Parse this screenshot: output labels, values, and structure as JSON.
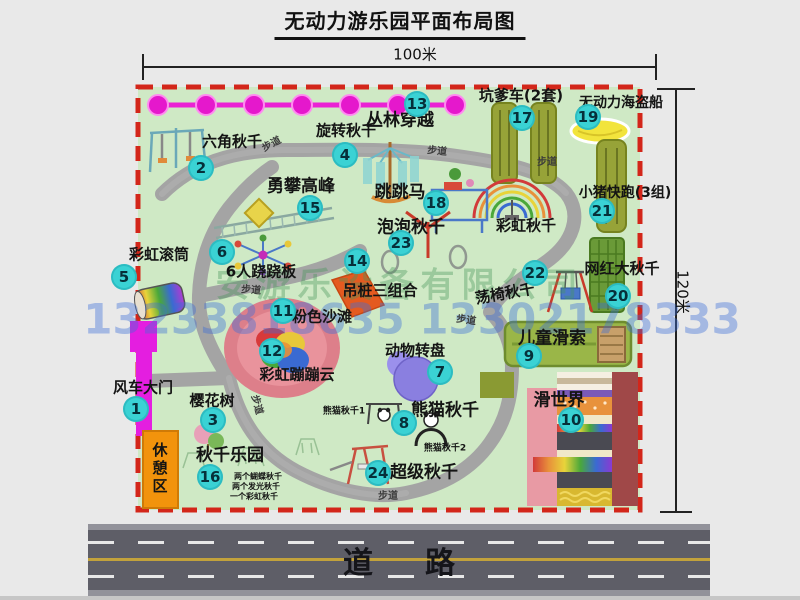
{
  "title": "无动力游乐园平面布局图",
  "dimensions": {
    "width": "100米",
    "height": "120米"
  },
  "road": {
    "label": "道路"
  },
  "path_label": "步道",
  "rest_area_label": "休憩区",
  "rainbow_swing_label": "彩虹秋千",
  "watermark": {
    "company": "安游乐设备有限公司",
    "phones": "13233818635 13302178333"
  },
  "attractions": [
    {
      "num": "1",
      "label": "风车大门"
    },
    {
      "num": "2",
      "label": "六角秋千"
    },
    {
      "num": "3",
      "label": "樱花树"
    },
    {
      "num": "4",
      "label": "旋转秋千"
    },
    {
      "num": "5",
      "label": "彩虹滚筒"
    },
    {
      "num": "6",
      "label": "6人跷跷板"
    },
    {
      "num": "7",
      "label": "动物转盘"
    },
    {
      "num": "8",
      "label": "熊猫秋千"
    },
    {
      "num": "9",
      "label": "儿童滑索"
    },
    {
      "num": "10",
      "label": "滑世界"
    },
    {
      "num": "11",
      "label": "粉色沙滩"
    },
    {
      "num": "12",
      "label": "彩虹蹦蹦云"
    },
    {
      "num": "13",
      "label": "丛林穿越"
    },
    {
      "num": "14",
      "label": "吊桩三组合"
    },
    {
      "num": "15",
      "label": "勇攀高峰"
    },
    {
      "num": "16",
      "label": "秋千乐园"
    },
    {
      "num": "17",
      "label": "坑爹车(2套)"
    },
    {
      "num": "18",
      "label": "跳跳马"
    },
    {
      "num": "19",
      "label": "无动力海盗船"
    },
    {
      "num": "20",
      "label": "网红大秋千"
    },
    {
      "num": "21",
      "label": "小猪快跑(3组)"
    },
    {
      "num": "22",
      "label": "荡椅秋千"
    },
    {
      "num": "23",
      "label": "泡泡秋千"
    },
    {
      "num": "24",
      "label": "超级秋千"
    }
  ],
  "sub_labels": {
    "panda_swing_1": "熊猫秋千1",
    "panda_swing_2": "熊猫秋千2",
    "swing_park_items": [
      "两个蝴蝶秋千",
      "两个发光秋千",
      "一个彩虹秋千"
    ]
  },
  "colors": {
    "map_green": "#cfe9c5",
    "border_red": "#d3261a",
    "badge_teal": "#3ad2d4",
    "chain_magenta": "#e81fd2",
    "gate_magenta": "#e41ee0",
    "rest_orange": "#f2930c",
    "road_gray": "#5e5e67",
    "lane_yellow": "#c2a23c"
  }
}
